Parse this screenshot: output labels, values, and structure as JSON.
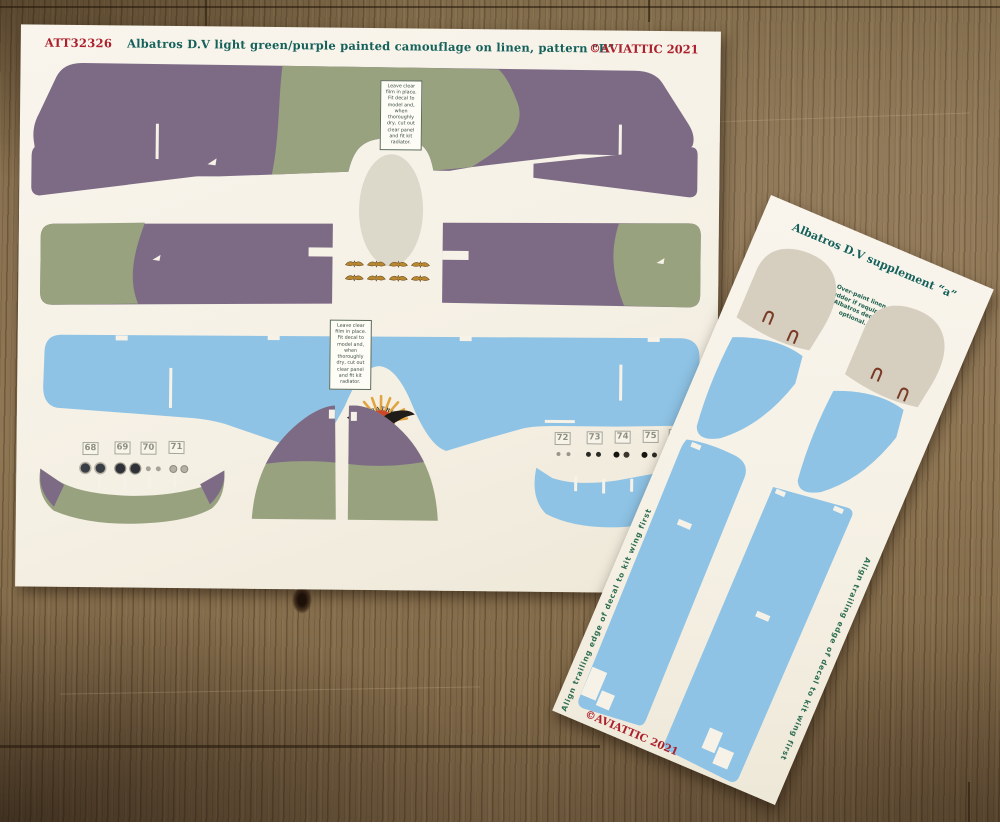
{
  "main_sheet": {
    "product_code": "ATT32326",
    "title": "Albatros D.V light green/purple painted camouflage on linen, pattern “E”",
    "copyright": "©AVIATTIC 2021",
    "instruction_text": "Leave clear film in place. Fit decal to model and, when thoroughly dry, cut out clear panel and fit kit radiator.",
    "logo_text": "ALBATROS",
    "left_numbers": [
      "68",
      "69",
      "70",
      "71"
    ],
    "right_numbers": [
      "72",
      "73",
      "74",
      "75",
      "76"
    ]
  },
  "supplement_sheet": {
    "title": "Albatros D.V supplement “a”",
    "note_text": "Over-paint linen rudder if required. Albatros decal optional.",
    "align_text_left": "Align trailing edge of decal to kit wing first",
    "align_text_right": "Align trailing edge of decal to kit wing first",
    "copyright": "©AVIATTIC 2021"
  },
  "colors": {
    "paper": "#f6f2e8",
    "camo_purple": "#7d6b86",
    "camo_green": "#98a27f",
    "linen_blue": "#8ec3e5",
    "linen_beige": "#d6cfc0",
    "red_text": "#ab1f2b",
    "teal_text": "#14605a",
    "gold_motif": "#b8872f",
    "wood_brown": "#8a7252"
  }
}
